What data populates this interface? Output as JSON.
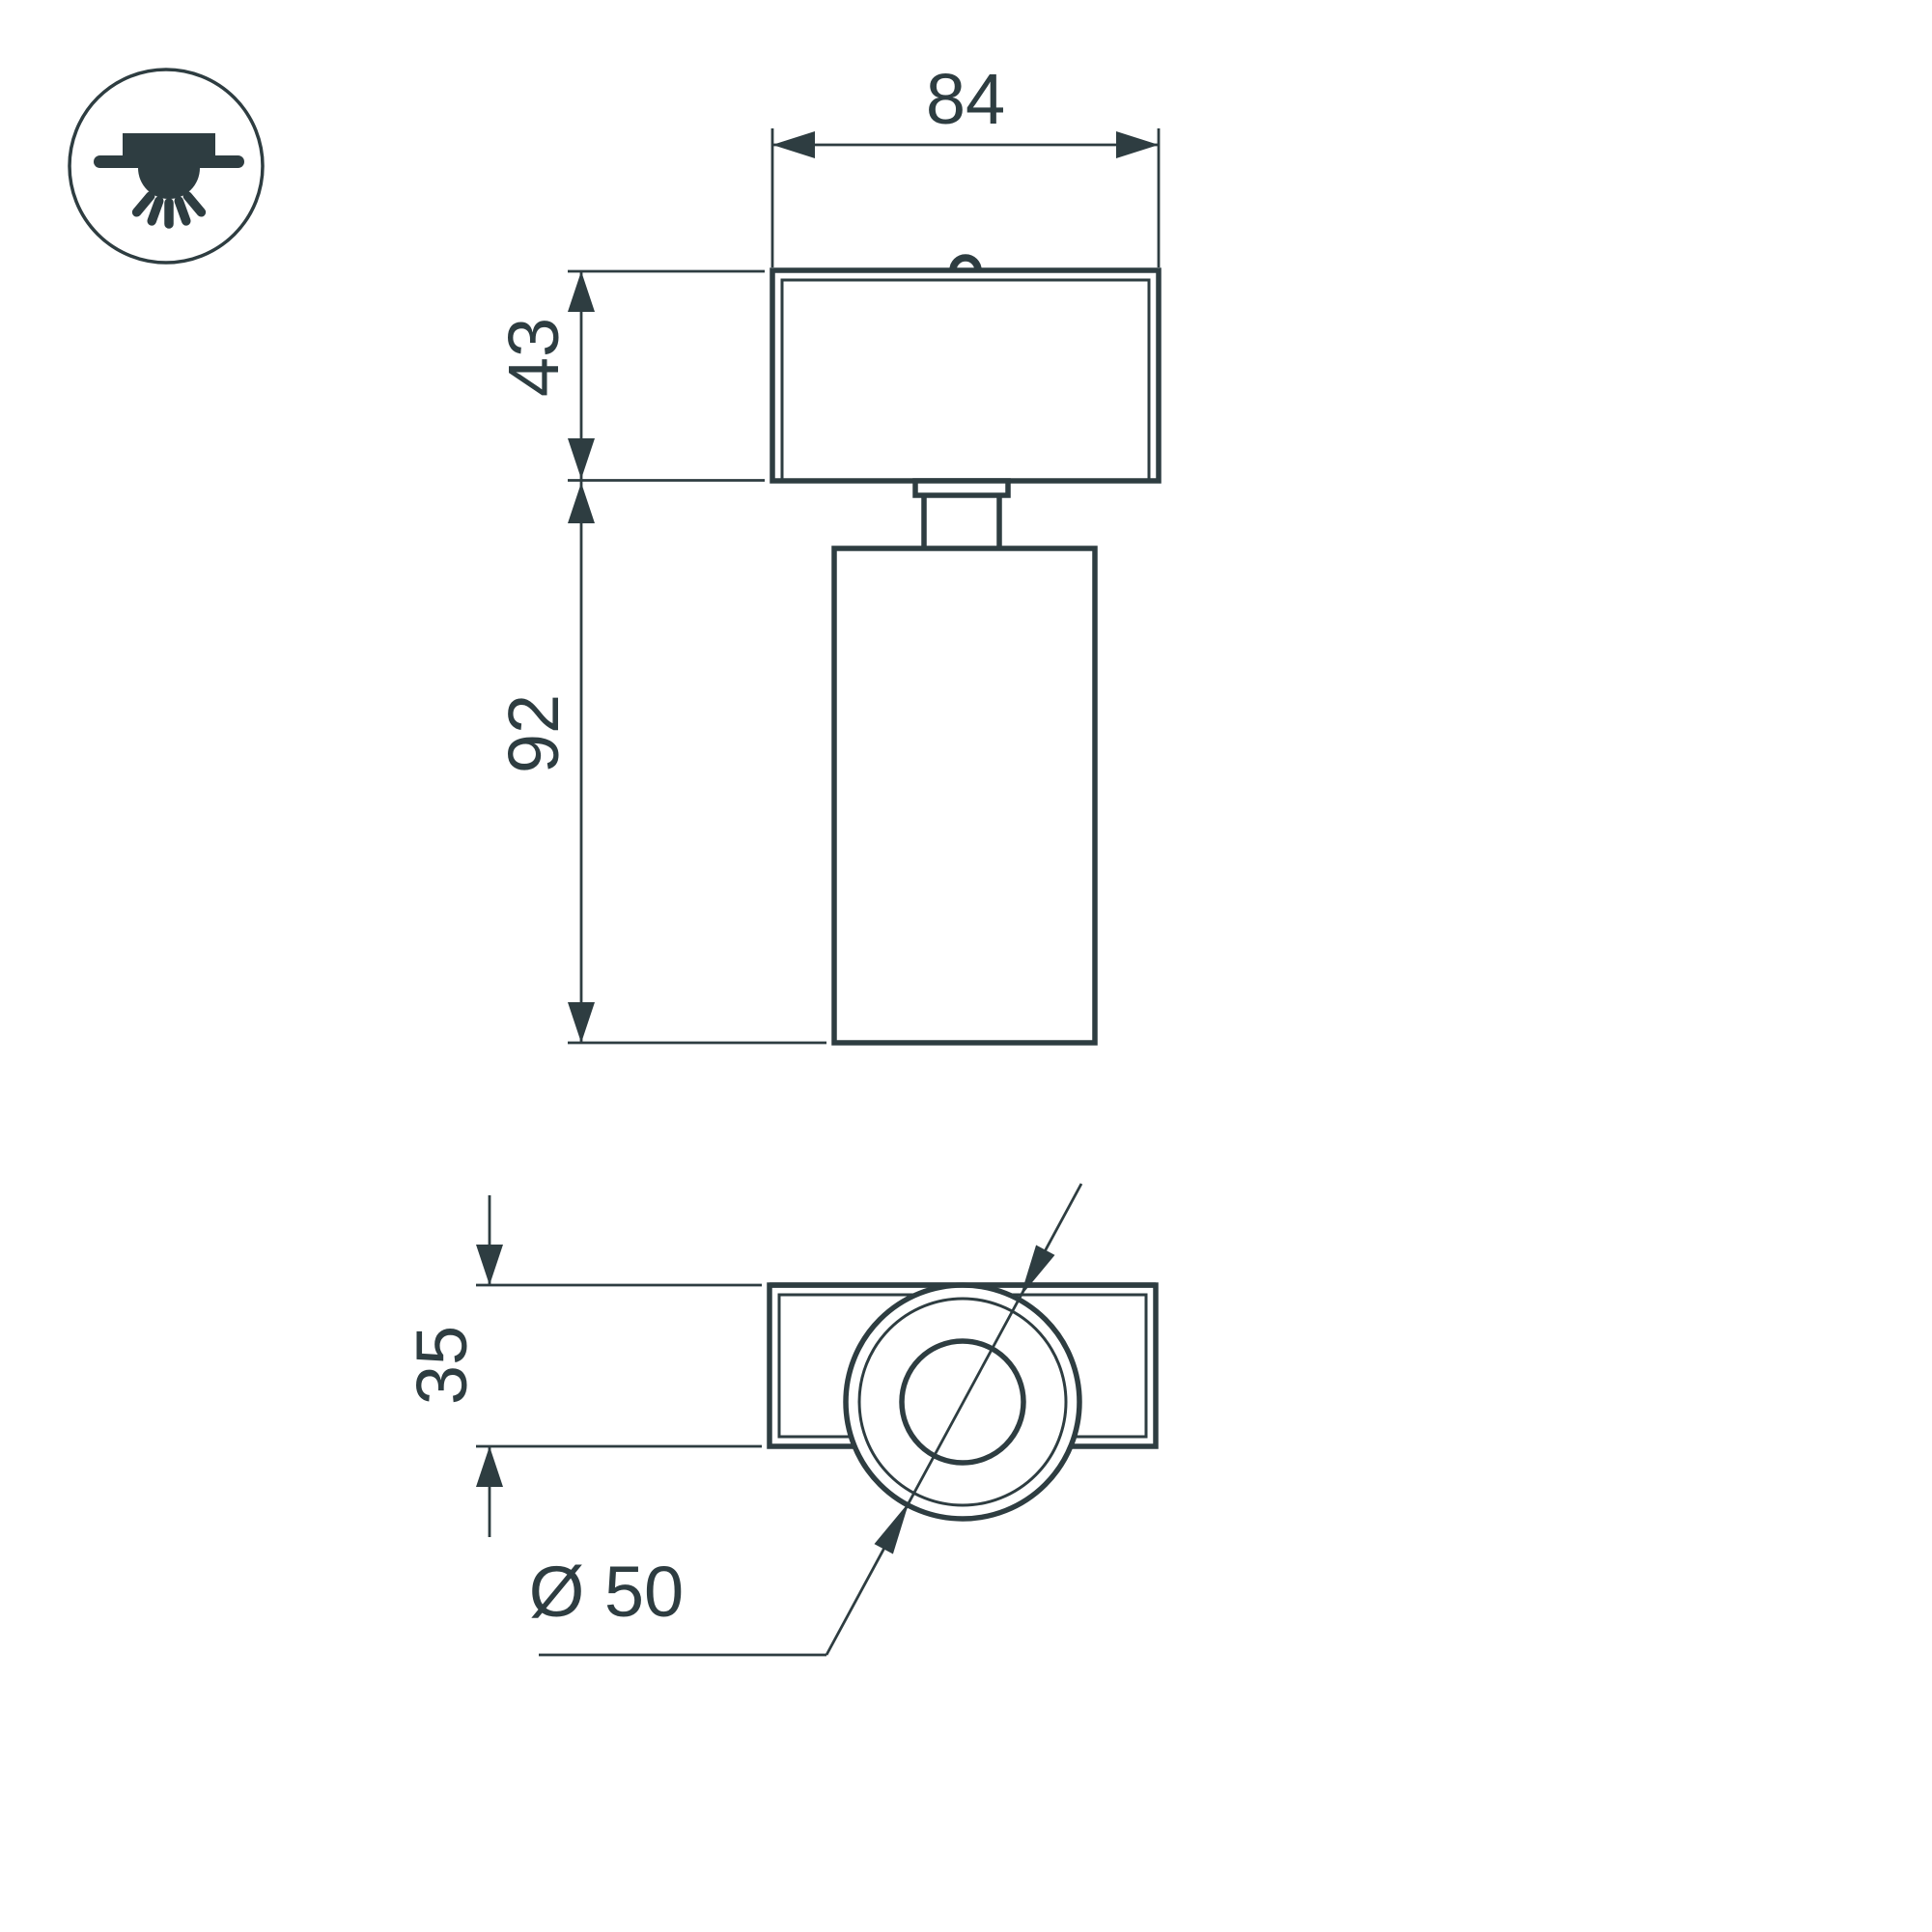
{
  "title": "Luminaire technical dimension drawing",
  "colors": {
    "line": "#2e3d41",
    "background": "#ffffff"
  },
  "icon": {
    "name": "surface-mounted-ceiling-light-icon"
  },
  "views": {
    "front": {
      "dim_width_top": "84",
      "dim_height_base": "43",
      "dim_height_body": "92"
    },
    "plan": {
      "dim_depth": "35",
      "dim_diameter": "Ø 50"
    }
  }
}
